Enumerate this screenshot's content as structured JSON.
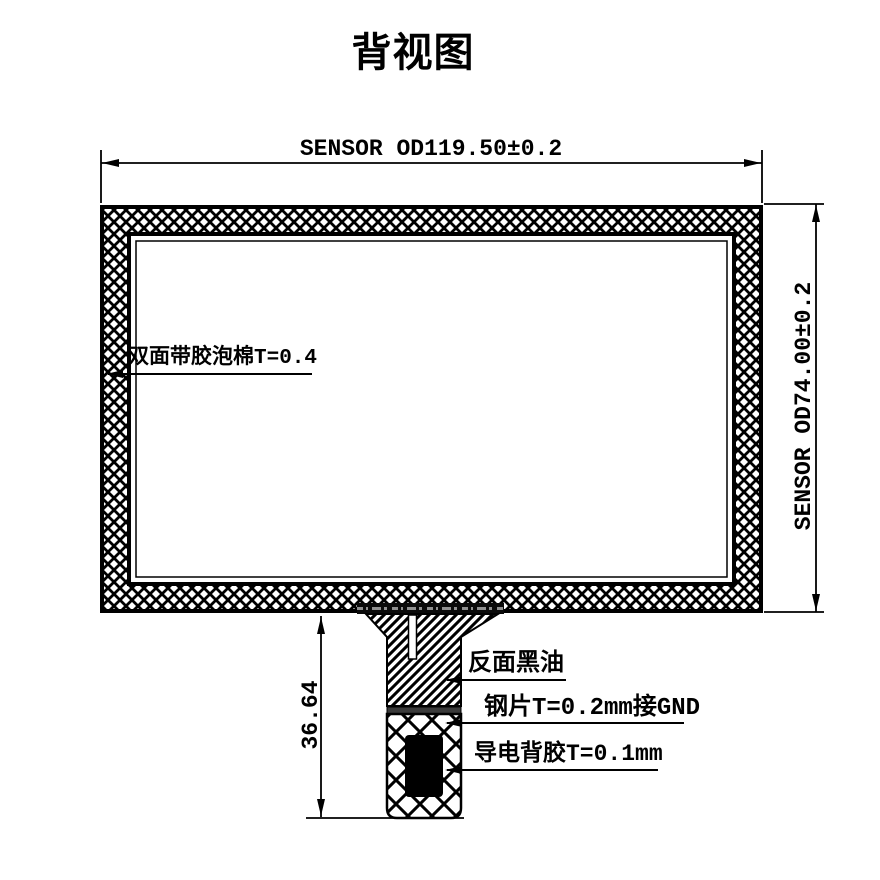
{
  "title": "背视图",
  "colors": {
    "ink": "#000000",
    "background": "#ffffff",
    "steel_band": "#3a3a3a"
  },
  "dimensions": {
    "top_width": "SENSOR OD119.50±0.2",
    "right_height": "SENSOR OD74.00±0.2",
    "tail_height": "36.64"
  },
  "callouts": {
    "foam": "双面带胶泡棉T=0.4",
    "back_black_ink": "反面黑油",
    "steel_sheet": "钢片T=0.2mm接GND",
    "conductive_adhesive": "导电背胶T=0.1mm"
  }
}
